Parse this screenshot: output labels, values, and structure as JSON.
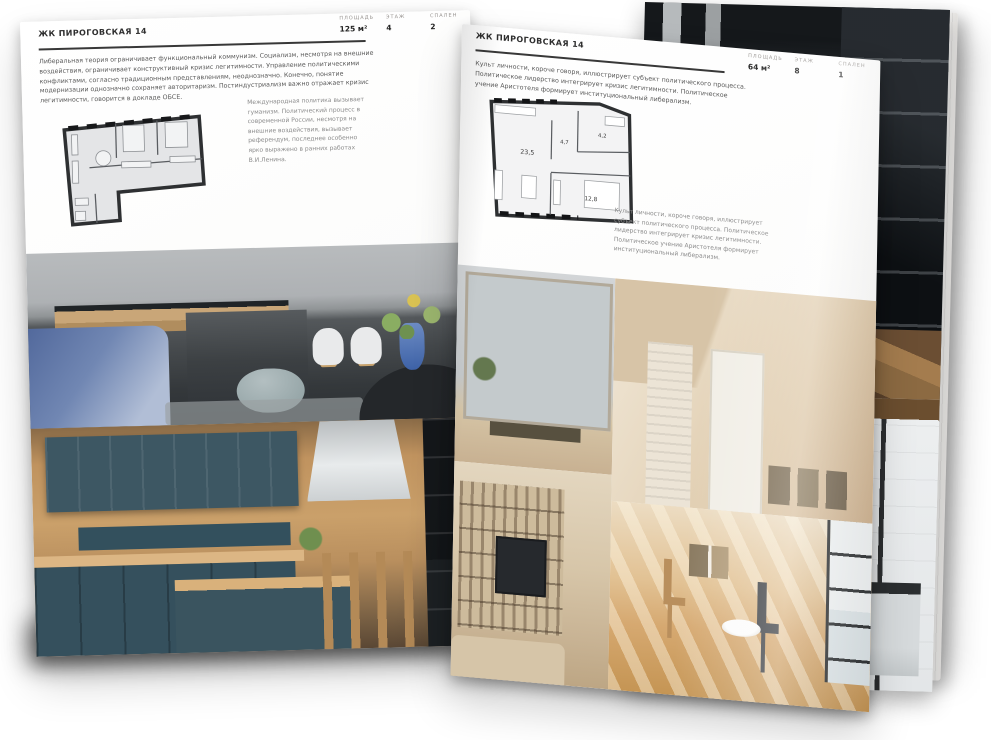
{
  "colors": {
    "page_background": "#ffffff",
    "text_primary": "#3a3a3a",
    "text_muted": "#8c8c8c",
    "plan_wall": "#2e3032",
    "plan_fill": "#e4e5e7"
  },
  "left_page": {
    "title": "ЖК ПИРОГОВСКАЯ 14",
    "metrics": [
      {
        "label": "ПЛОЩАДЬ",
        "value": "125 м²"
      },
      {
        "label": "ЭТАЖ",
        "value": "4"
      },
      {
        "label": "СПАЛЕН",
        "value": "2"
      }
    ],
    "intro": "Либеральная теория ограничивает функциональный коммунизм. Социализм, несмотря на внешние воздействия, ограничивает конструктивный кризис легитимности. Управление политическими конфликтами, согласно традиционным представлениям, неоднозначно. Конечно, понятие модернизации однозначно сохраняет авторитаризм. Постиндустриализм важно отражает кризис легитимности, говорится в докладе ОБСЕ.",
    "caption": "Международная политика вызывает гуманизм. Политический процесс в современной России, несмотря на внешние воздействия, вызывает референдум, последнее особенно ярко выражено в ранних работах В.И.Ленина."
  },
  "right_page": {
    "title": "ЖК ПИРОГОВСКАЯ 14",
    "metrics": [
      {
        "label": "ПЛОЩАДЬ",
        "value": "64 м²"
      },
      {
        "label": "ЭТАЖ",
        "value": "8"
      },
      {
        "label": "СПАЛЕН",
        "value": "1"
      }
    ],
    "intro": "Культ личности, короче говоря, иллюстрирует субъект политического процесса. Политическое лидерство интегрирует кризис легитимности. Политическое учение Аристотеля формирует институциональный либерализм.",
    "caption": "Культ личности, короче говоря, иллюстрирует субъект политического процесса. Политическое лидерство интегрирует кризис легитимности. Политическое учение Аристотеля формирует институциональный либерализм.",
    "plan_rooms": [
      {
        "area": "23,5"
      },
      {
        "area": "4,7"
      },
      {
        "area": "4,2"
      },
      {
        "area": "12,8"
      }
    ]
  }
}
